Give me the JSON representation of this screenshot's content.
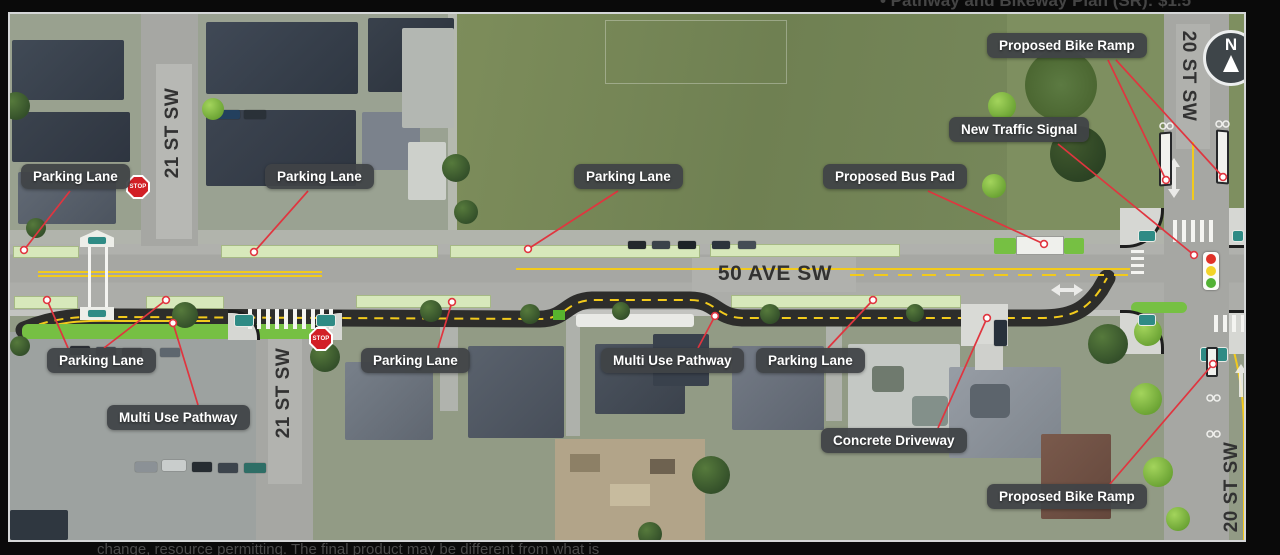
{
  "page": {
    "top_caption": "• Pathway and Bikeway Plan (SR): $1.5",
    "bottom_caption": "change, resource permitting. The final product may be different from what is"
  },
  "map": {
    "streets": {
      "ave50": "50 AVE SW",
      "st21_top": "21 ST SW",
      "st21_bottom": "21 ST SW",
      "st20_top": "20 ST SW",
      "st20_bottom": "20 ST SW"
    },
    "annotations": [
      {
        "id": "parking-lane-nw",
        "label": "Parking Lane"
      },
      {
        "id": "parking-lane-n2",
        "label": "Parking Lane"
      },
      {
        "id": "parking-lane-n3",
        "label": "Parking Lane"
      },
      {
        "id": "proposed-bus-pad",
        "label": "Proposed Bus Pad"
      },
      {
        "id": "new-traffic-signal",
        "label": "New Traffic Signal"
      },
      {
        "id": "proposed-bike-ramp-north",
        "label": "Proposed Bike Ramp"
      },
      {
        "id": "parking-lane-sw",
        "label": "Parking Lane"
      },
      {
        "id": "multi-use-pathway-west",
        "label": "Multi Use Pathway"
      },
      {
        "id": "parking-lane-s2",
        "label": "Parking Lane"
      },
      {
        "id": "multi-use-pathway-center",
        "label": "Multi Use Pathway"
      },
      {
        "id": "parking-lane-s3",
        "label": "Parking Lane"
      },
      {
        "id": "concrete-driveway",
        "label": "Concrete Driveway"
      },
      {
        "id": "proposed-bike-ramp-south",
        "label": "Proposed Bike Ramp"
      }
    ],
    "compass_label": "N",
    "stop_sign": "STOP",
    "colors": {
      "annotation_bg": "#434649",
      "leader_red": "#e0353f",
      "parking_lane_green": "#d7e8bb",
      "boulevard_green": "#76c043",
      "pathway_asphalt": "#2d2d2b",
      "centerline_yellow": "#f2ca1c",
      "curb_ramp_teal": "#2f8b85",
      "signal_red": "#e03127",
      "signal_yellow": "#f3d429",
      "signal_green": "#53b234"
    }
  }
}
